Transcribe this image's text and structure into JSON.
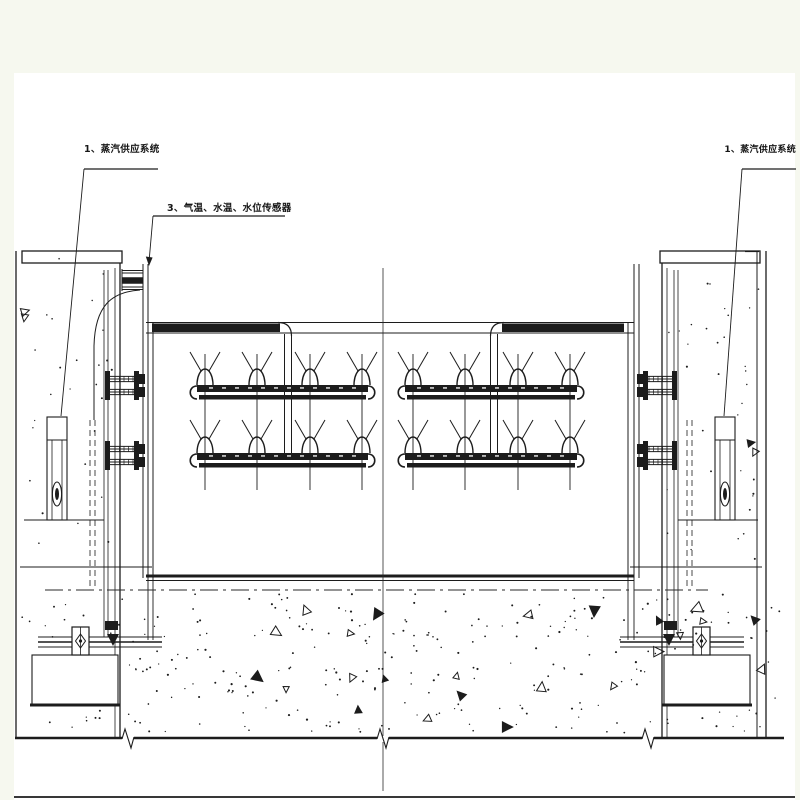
{
  "page": {
    "background": "#f6f8ef",
    "paper": "#ffffff",
    "ink": "#1c1c1c"
  },
  "labels": {
    "steam_left": "1、蒸汽供应系统",
    "sensors": "3、气温、水温、水位传感器",
    "steam_right": "1、蒸汽供应系统"
  },
  "figure": {
    "type": "engineering-section-diagram",
    "manifolds": {
      "rows": 2,
      "row_base_y": [
        385,
        453
      ],
      "bars": [
        {
          "x1": 197,
          "x2": 368
        },
        {
          "x1": 405,
          "x2": 577
        }
      ],
      "nozzle_x_left": [
        205,
        257,
        310,
        362
      ],
      "nozzle_x_right": [
        413,
        465,
        518,
        570
      ],
      "nozzles_per_bar": 4,
      "stem_top_y": 354,
      "stem_bottom_y": 490
    },
    "ground": {
      "line_y": 738,
      "breaks_x": [
        128,
        383,
        648
      ],
      "bottom_line_y": 797
    },
    "centerline": {
      "x": 383,
      "dashdot_y": 590
    }
  }
}
